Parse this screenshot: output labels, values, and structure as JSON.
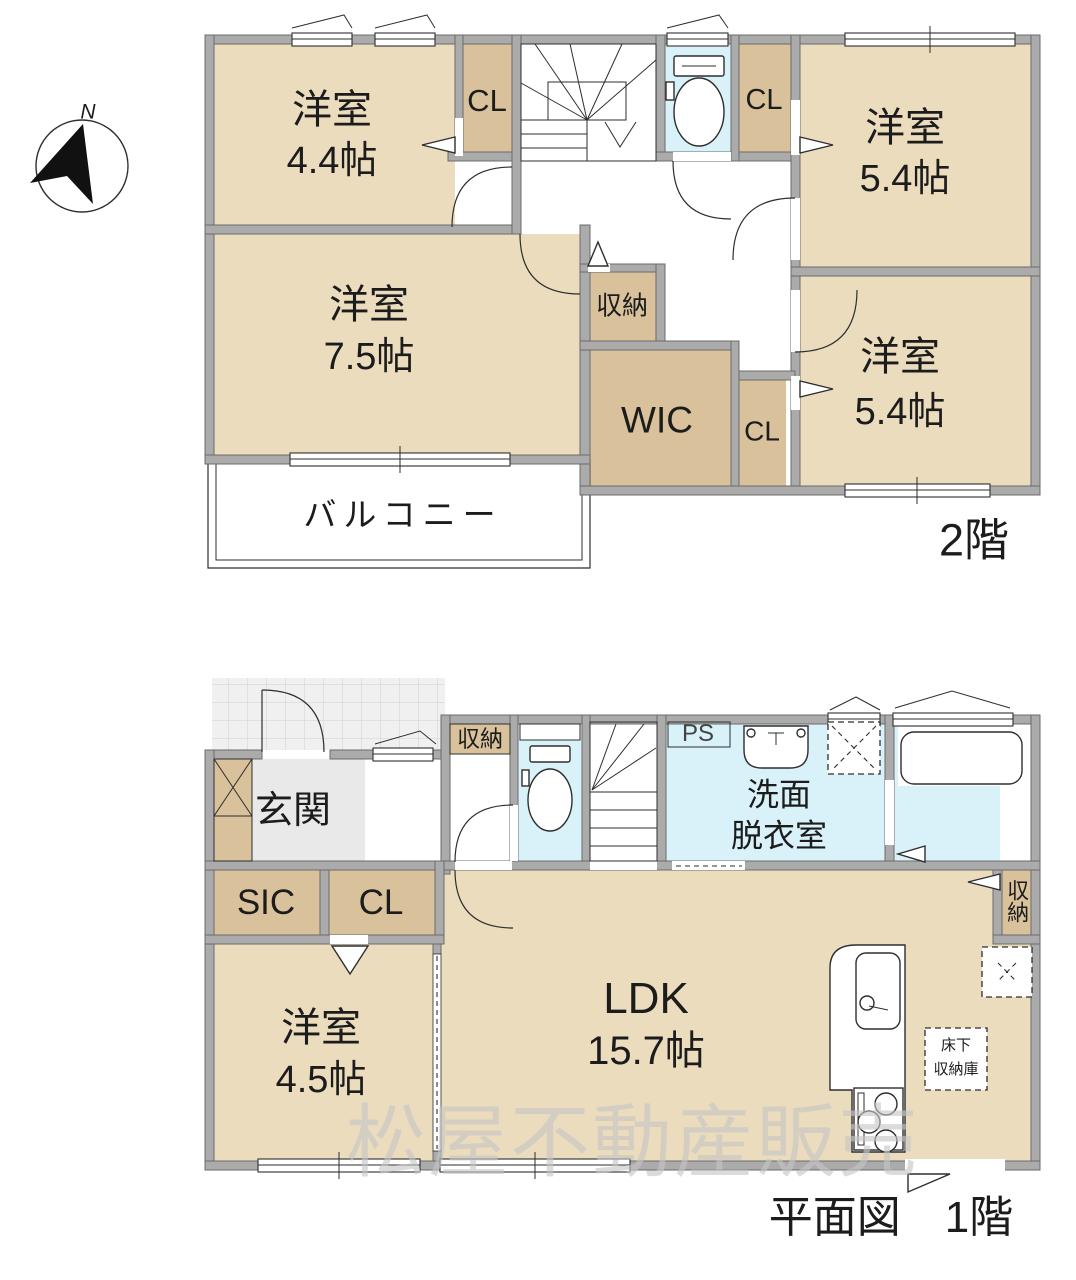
{
  "colors": {
    "room": "#ebdcbe",
    "closet": "#d8c19b",
    "wet": "#d9f1f8",
    "wall": "#ababab",
    "entry": "#e9e9e9",
    "tile": "#f0f0f0",
    "watermark": "#c6c6c6"
  },
  "compass": {
    "n": "N"
  },
  "watermark": "松屋不動産販売",
  "floor2": {
    "floor_label": "2階",
    "rooms": {
      "r44": {
        "name": "洋室",
        "size": "4.4帖"
      },
      "r75": {
        "name": "洋室",
        "size": "7.5帖"
      },
      "r54a": {
        "name": "洋室",
        "size": "5.4帖"
      },
      "r54b": {
        "name": "洋室",
        "size": "5.4帖"
      }
    },
    "closets": {
      "cl_a": "CL",
      "cl_b": "CL",
      "cl_c": "CL"
    },
    "storage": "収納",
    "wic": "WIC",
    "balcony": "バルコニー"
  },
  "floor1": {
    "caption": "平面図　1階",
    "entrance": "玄関",
    "sic": "SIC",
    "cl": "CL",
    "hall_storage": "収納",
    "ldk_storage": "収納",
    "ps": "PS",
    "washroom_line1": "洗面",
    "washroom_line2": "脱衣室",
    "room45": {
      "name": "洋室",
      "size": "4.5帖"
    },
    "ldk": {
      "name": "LDK",
      "size": "15.7帖"
    },
    "underfloor_line1": "床下",
    "underfloor_line2": "収納庫"
  }
}
